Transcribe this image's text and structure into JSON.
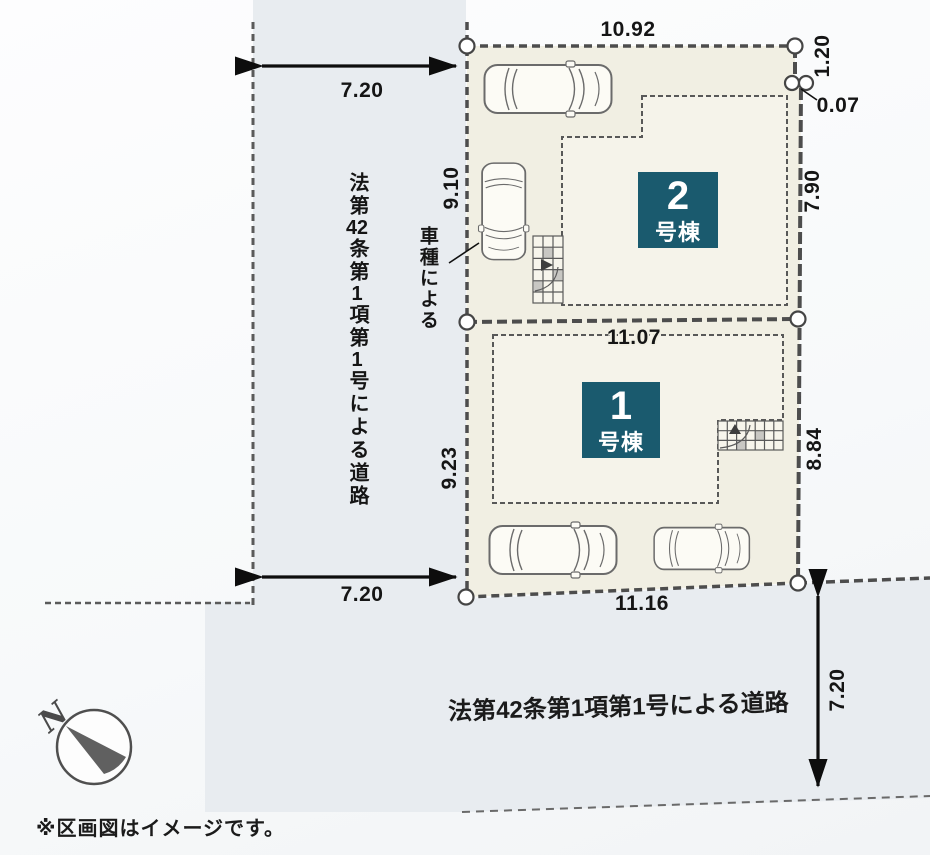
{
  "caption": "※区画図はイメージです。",
  "colors": {
    "accent_teal": "#1a5a6e",
    "plot_fill": "#f1efe3",
    "building_fill": "#f5f3ea",
    "road_fill": "#e8ecf0",
    "line": "#4d4d4d"
  },
  "compass": {
    "north_label": "N"
  },
  "roads": {
    "left": {
      "label": "法第42条第1項第1号による道路",
      "label_segments": [
        "法第",
        "42",
        "条第",
        "1",
        "項第",
        "1",
        "号による道路"
      ],
      "width_top": "7.20",
      "width_bottom": "7.20"
    },
    "bottom": {
      "label": "法第42条第1項第1号による道路",
      "width": "7.20"
    }
  },
  "site": {
    "note_car": "車種による",
    "dims": {
      "top_width": "10.92",
      "right_setback": "1.20",
      "right_jog": "0.07",
      "plot2_left": "9.10",
      "plot2_right": "7.90",
      "boundary_width": "11.07",
      "plot1_left": "9.23",
      "plot1_right": "8.84",
      "bottom_width": "11.16"
    },
    "buildings": [
      {
        "number": "1",
        "suffix": "号棟"
      },
      {
        "number": "2",
        "suffix": "号棟"
      }
    ]
  }
}
